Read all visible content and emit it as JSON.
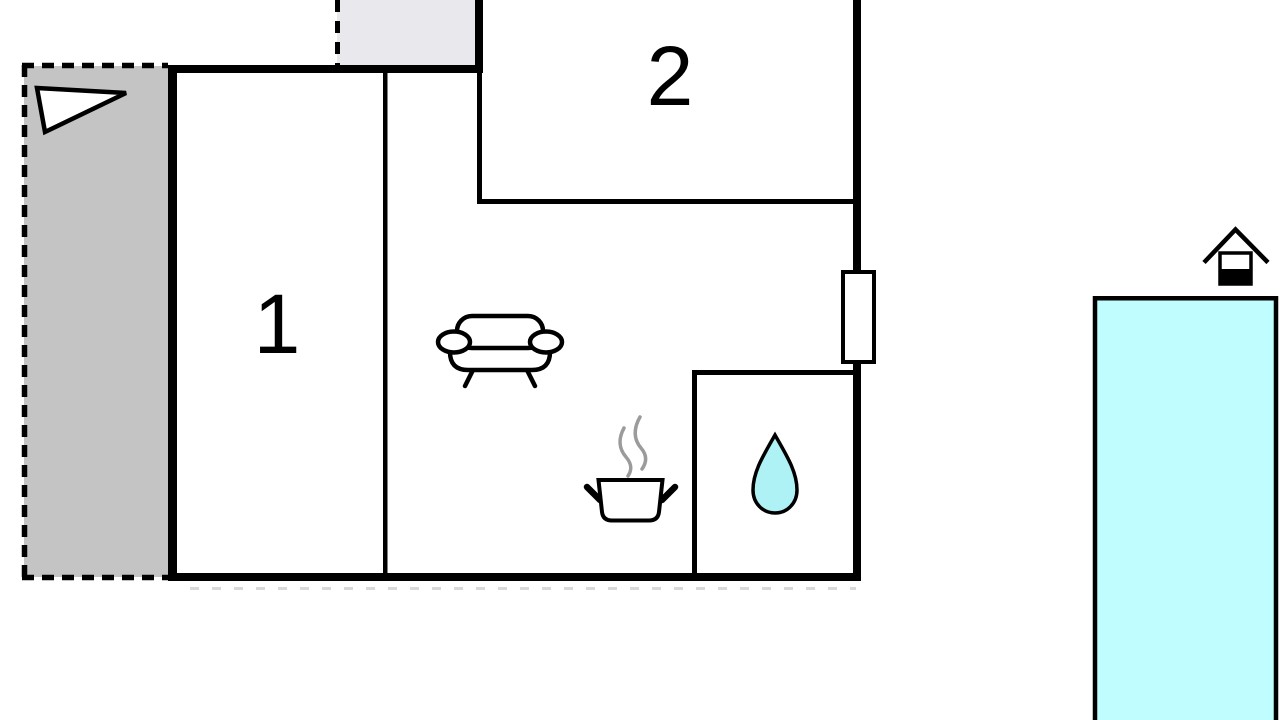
{
  "floorplan": {
    "kind": "vacation-home-floor-plan",
    "room_labels": {
      "room1": "1",
      "room2": "2"
    },
    "icons": {
      "direction_arrow": "direction-arrow",
      "sofa": "sofa-top-view",
      "cooking_pot": "steaming-cooking-pot",
      "water_drop": "water-drop",
      "pool_house": "pool-house"
    },
    "colors": {
      "wall": "#000000",
      "terrace": "#c4c4c4",
      "porch": "#e9e9ed",
      "pool": "#bffdff",
      "water_drop": "#aef2f6",
      "steam": "#9b9b9b",
      "wall_shadow": "#d9d9d9"
    }
  }
}
